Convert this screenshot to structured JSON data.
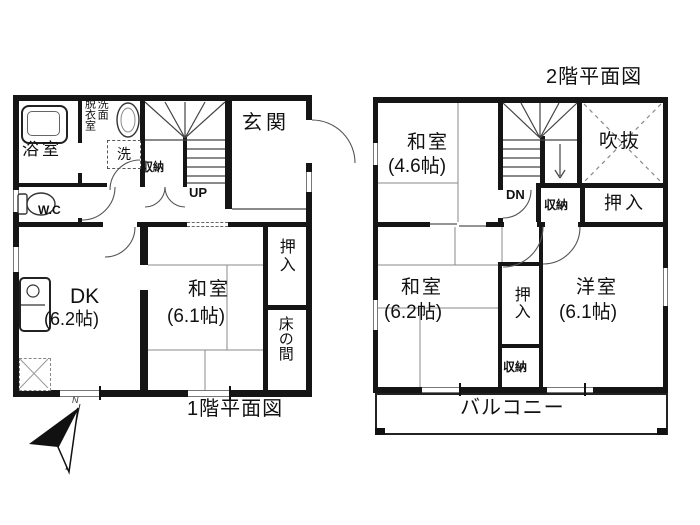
{
  "floor1": {
    "title": "1階平面図",
    "bathroom": "浴室",
    "dressing_room": "脱衣室",
    "washroom": "洗面",
    "washer": "洗",
    "stair_storage": "収納",
    "up": "UP",
    "entrance": "玄関",
    "wc": "W.C",
    "dk": "DK",
    "dk_size": "(6.2帖)",
    "washitsu": "和室",
    "washitsu_size": "(6.1帖)",
    "oshiire": "押入",
    "tokonoma": "床の間"
  },
  "floor2": {
    "title": "2階平面図",
    "washitsu_a": "和室",
    "washitsu_a_size": "(4.6帖)",
    "dn": "DN",
    "void_space": "吹抜",
    "storage_a": "収納",
    "oshiire_a": "押入",
    "washitsu_b": "和室",
    "washitsu_b_size": "(6.2帖)",
    "oshiire_b": "押入",
    "storage_b": "収納",
    "youshitsu": "洋室",
    "youshitsu_size": "(6.1帖)",
    "balcony": "バルコニー"
  },
  "compass": {
    "north": "N"
  },
  "colors": {
    "wall": "#151515",
    "line": "#444444",
    "background": "#ffffff"
  }
}
